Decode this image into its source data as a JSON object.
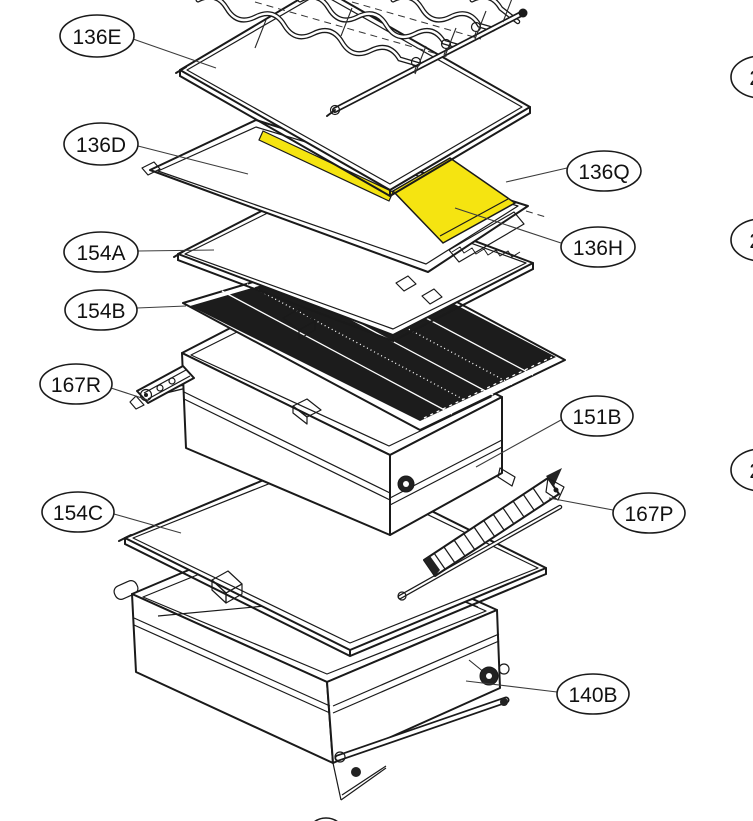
{
  "colors": {
    "background": "#ffffff",
    "line": "#1a1a1a",
    "leader": "#3c3c3c",
    "highlight": "#f5e411",
    "dark_band": "#1c1c1c"
  },
  "callouts": {
    "c136e": {
      "label": "136E"
    },
    "c136d": {
      "label": "136D"
    },
    "c154a": {
      "label": "154A"
    },
    "c154b": {
      "label": "154B"
    },
    "c167r": {
      "label": "167R"
    },
    "c154c": {
      "label": "154C"
    },
    "c136q": {
      "label": "136Q"
    },
    "c136h": {
      "label": "136H"
    },
    "c151b": {
      "label": "151B"
    },
    "c167p": {
      "label": "167P"
    },
    "c140b": {
      "label": "140B"
    },
    "p24_top": {
      "label": "24"
    },
    "p24_mid": {
      "label": "24"
    },
    "p24_bottom": {
      "label": "24"
    }
  }
}
